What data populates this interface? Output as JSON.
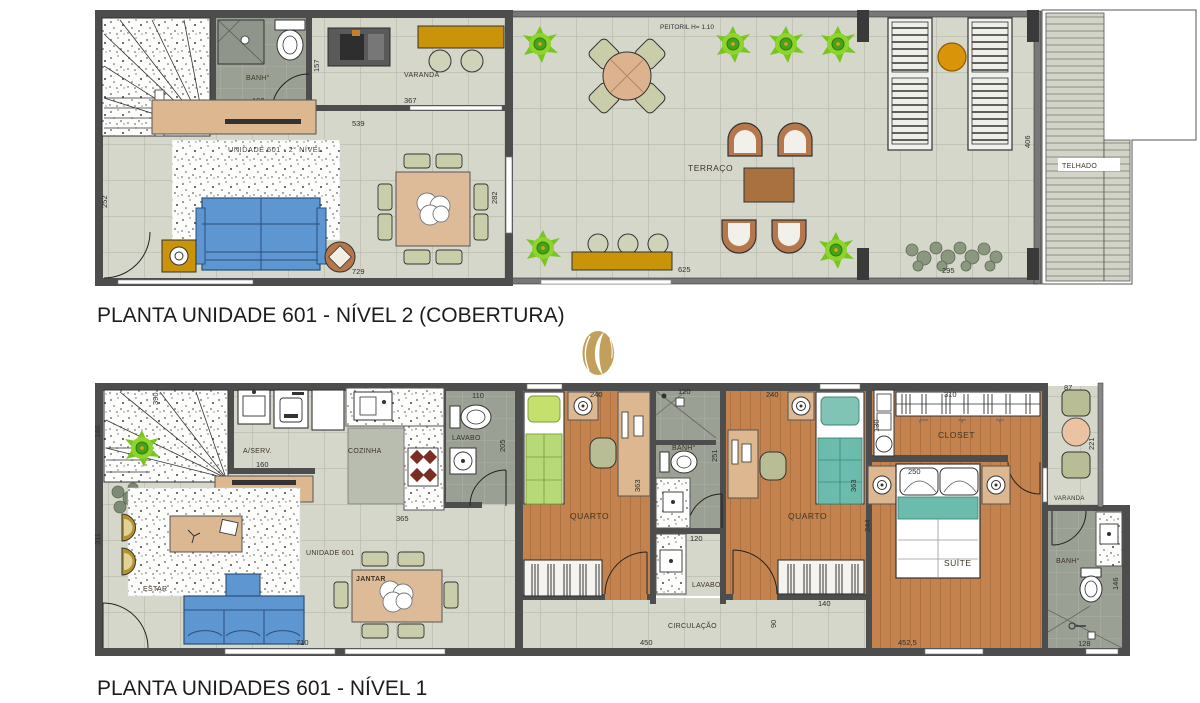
{
  "colors": {
    "wall": "#4d4d4d",
    "parapet": "#787878",
    "tile_floor": "#d5d7cb",
    "bath_floor": "#9ba094",
    "wood_floor": "#c4834e",
    "accent_gold": "#c9940a",
    "sofa_blue": "#5e96d2",
    "bed_green": "#b8d977",
    "bed_teal": "#6cbcae",
    "plant_green": "#8ed32f",
    "logo_gold": "#c2a05c"
  },
  "logo": {
    "icon": "gold-swirl-logo"
  },
  "plan_upper": {
    "title": "PLANTA UNIDADE 601 - NÍVEL 2 (COBERTURA)",
    "labels": {
      "banh": "BANH°",
      "varanda": "VARANDA",
      "terraco": "TERRAÇO",
      "telhado": "TELHADO",
      "rug": "UNIDADE 601 - 2° NÍVEL",
      "peitoril": "PEITORIL H= 1.10"
    },
    "dims": {
      "banh_width": "160",
      "banh_height": "157",
      "hall_width": "539",
      "varanda_width": "367",
      "living_height": "252",
      "dining_door": "282",
      "living_width": "729",
      "terraco_width": "625",
      "planter_width": "295",
      "deck_height": "406"
    }
  },
  "plan_lower": {
    "title": "PLANTA UNIDADES 601 - NÍVEL 1",
    "labels": {
      "aserv": "A/SERV.",
      "cozinha": "COZINHA",
      "lavabo_top": "LAVABO",
      "estar": "ESTAR",
      "jantar": "JANTAR",
      "unit": "UNIDADE 601",
      "quarto1": "QUARTO",
      "banh1": "BANH°",
      "lavabo2": "LAVABO",
      "circulacao": "CIRCULAÇÃO",
      "quarto2": "QUARTO",
      "closet": "CLOSET",
      "suite": "SUÍTE",
      "varanda": "VARANDA",
      "banh2": "BANH°"
    },
    "dims": {
      "stairs_width": "390",
      "stairs_height": "146",
      "aserv_width": "160",
      "lavabo_width": "110",
      "lavabo_height": "205",
      "kitchen_counter": "365",
      "quarto1_width": "240",
      "quarto1_depth": "363",
      "banh1_width": "120",
      "banh1_height": "251",
      "lavabo2_width": "120",
      "quarto2_width": "240",
      "quarto2_depth": "363",
      "quarto2_door": "140",
      "closet_shelf": "130",
      "closet_rail": "310",
      "suite_height": "244",
      "bed_width": "250",
      "suite_width": "452,5",
      "varanda_width": "87",
      "varanda_height": "221",
      "banh2_toilet": "146",
      "banh2_width": "128",
      "estar_height": "311",
      "estar_width": "710",
      "circ_width": "450",
      "circ_height": "90"
    }
  }
}
